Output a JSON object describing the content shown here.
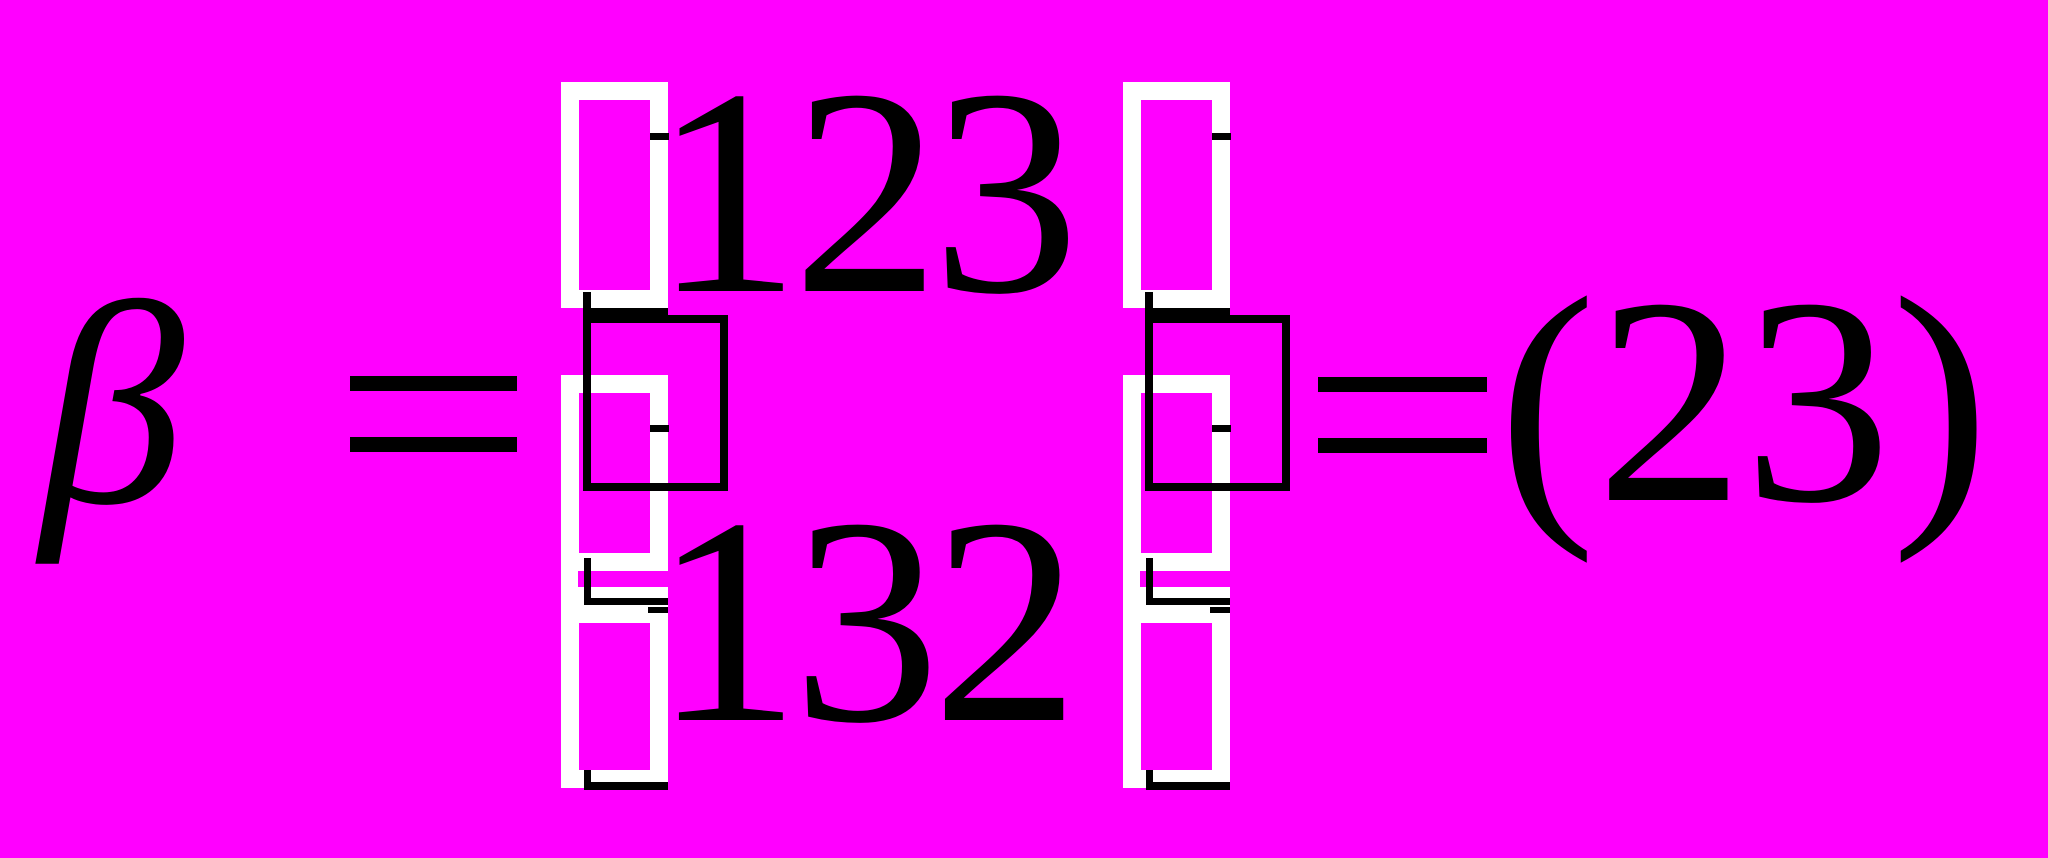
{
  "title": "Rendered equation with corrupted bracket glyphs",
  "colors": {
    "background": "#FF00FF",
    "ink": "#000000",
    "glyph_box": "#FFFFFF"
  },
  "equation": {
    "lhs_symbol": "β",
    "equals_first": "=",
    "permutation": {
      "top_row": "123",
      "bottom_row": "132"
    },
    "equals_second": "=",
    "result": "(23)"
  }
}
